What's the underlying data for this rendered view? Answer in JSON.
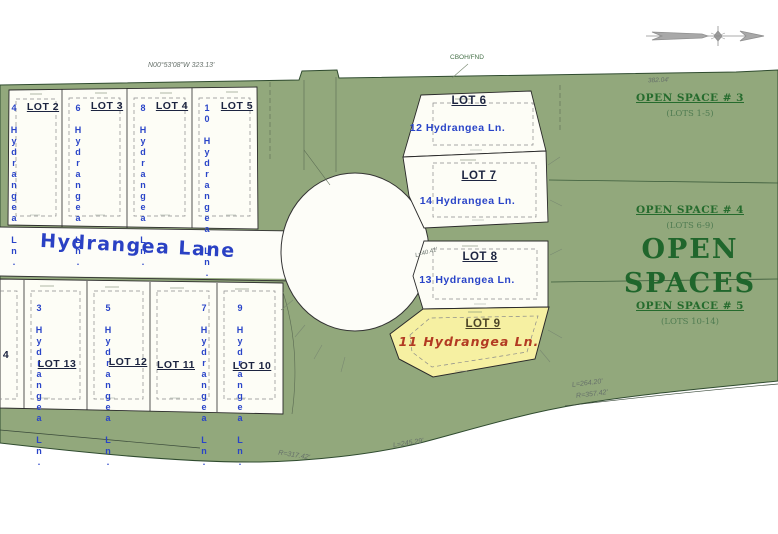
{
  "street": {
    "name": "Hydrangea Lane"
  },
  "survey": {
    "top_bearing": "N00°53'08\"W   323.13'",
    "corner_marker": "CBOH/FND",
    "east_distance": "382.04'",
    "curve_r1": "R=317.42'",
    "curve_l1": "L=245.29'",
    "curve_l2": "L=264.20'",
    "curve_r2": "R=357.42'",
    "curve_l3": "L=40.41'"
  },
  "open_spaces": {
    "heading_line1": "OPEN",
    "heading_line2": "SPACES",
    "areas": [
      {
        "name": "OPEN SPACE # 3",
        "lots": "(LOTS 1-5)"
      },
      {
        "name": "OPEN SPACE # 4",
        "lots": "(LOTS 6-9)"
      },
      {
        "name": "OPEN SPACE # 5",
        "lots": "(LOTS 10-14)"
      }
    ]
  },
  "lots": {
    "north_row": [
      {
        "label": "LOT 2",
        "address": "4 Hydrangea Ln."
      },
      {
        "label": "LOT 3",
        "address": "6 Hydrangea Ln."
      },
      {
        "label": "LOT 4",
        "address": "8 Hydrangea Ln."
      },
      {
        "label": "LOT 5",
        "address": "10 Hydrangea Ln."
      }
    ],
    "south_row": [
      {
        "label": "LOT 13",
        "address": "3 Hydrangea Ln."
      },
      {
        "label": "LOT 12",
        "address": "5 Hydrangea Ln."
      },
      {
        "label": "LOT 11",
        "address": "7 Hydrangea Ln."
      },
      {
        "label": "LOT 10",
        "address": "9 Hydrangea Ln."
      }
    ],
    "culdesac": [
      {
        "label": "LOT 6",
        "address": "12 Hydrangea Ln."
      },
      {
        "label": "LOT 7",
        "address": "14 Hydrangea Ln."
      },
      {
        "label": "LOT 8",
        "address": "13 Hydrangea Ln."
      },
      {
        "label": "LOT 9",
        "address": "11 Hydrangea Ln.",
        "highlighted": true
      }
    ],
    "partial_west": {
      "label": "4"
    }
  },
  "icons": {
    "north_arrow": "north-arrow-icon"
  },
  "colors": {
    "open_space_green": "#92a87c",
    "lot_fill": "#fdfdf6",
    "lot9_highlight": "#f6f0a2",
    "address_blue": "#2944c8",
    "highlight_red": "#b23a22",
    "open_space_text": "#256b2d"
  }
}
